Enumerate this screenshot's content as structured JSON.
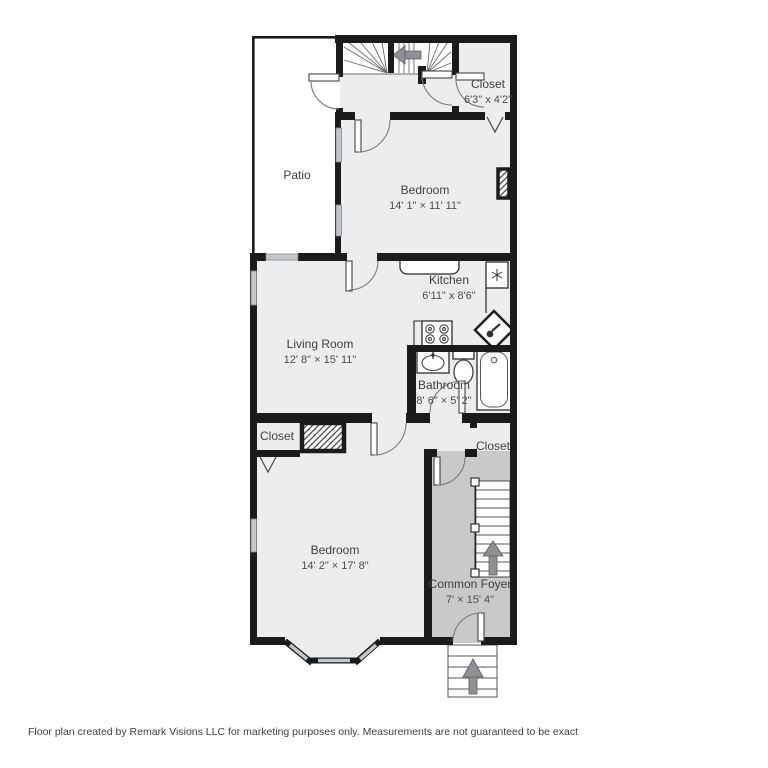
{
  "floor_plan": {
    "rooms": [
      {
        "id": "patio",
        "name": "Patio",
        "dims": ""
      },
      {
        "id": "closet-top",
        "name": "Closet",
        "dims": "6'3\" x 4'2\""
      },
      {
        "id": "bedroom-top",
        "name": "Bedroom",
        "dims": "14' 1\" × 11' 11\""
      },
      {
        "id": "kitchen",
        "name": "Kitchen",
        "dims": "6'11\" x 8'6\""
      },
      {
        "id": "living-room",
        "name": "Living Room",
        "dims": "12' 8\" × 15' 11\""
      },
      {
        "id": "bathroom",
        "name": "Bathroom",
        "dims": "8' 6\" × 5' 2\""
      },
      {
        "id": "closet-left",
        "name": "Closet",
        "dims": ""
      },
      {
        "id": "closet-right",
        "name": "Closet",
        "dims": ""
      },
      {
        "id": "bedroom-bottom",
        "name": "Bedroom",
        "dims": "14' 2\" × 17' 8\""
      },
      {
        "id": "common-foyer",
        "name": "Common Foyer",
        "dims": "7' × 15' 4\""
      }
    ],
    "icons": [
      "fridge-snowflake-icon",
      "stove-burners-icon",
      "corner-sink-icon",
      "bathroom-sink-icon",
      "toilet-icon",
      "bathtub-icon",
      "stairs-up-arrow-icon",
      "closet-rod-v-marker"
    ],
    "colors": {
      "wall": "#1a1b1d",
      "room_fill": "#ecedef",
      "foyer_fill": "#c7c9cb",
      "window_fill": "#c4c7ca",
      "arrow": "#8f9093",
      "patio_fill": "#ffffff"
    },
    "footer": "Floor plan created by Remark Visions LLC for marketing purposes only. Measurements are not guaranteed to be exact"
  }
}
